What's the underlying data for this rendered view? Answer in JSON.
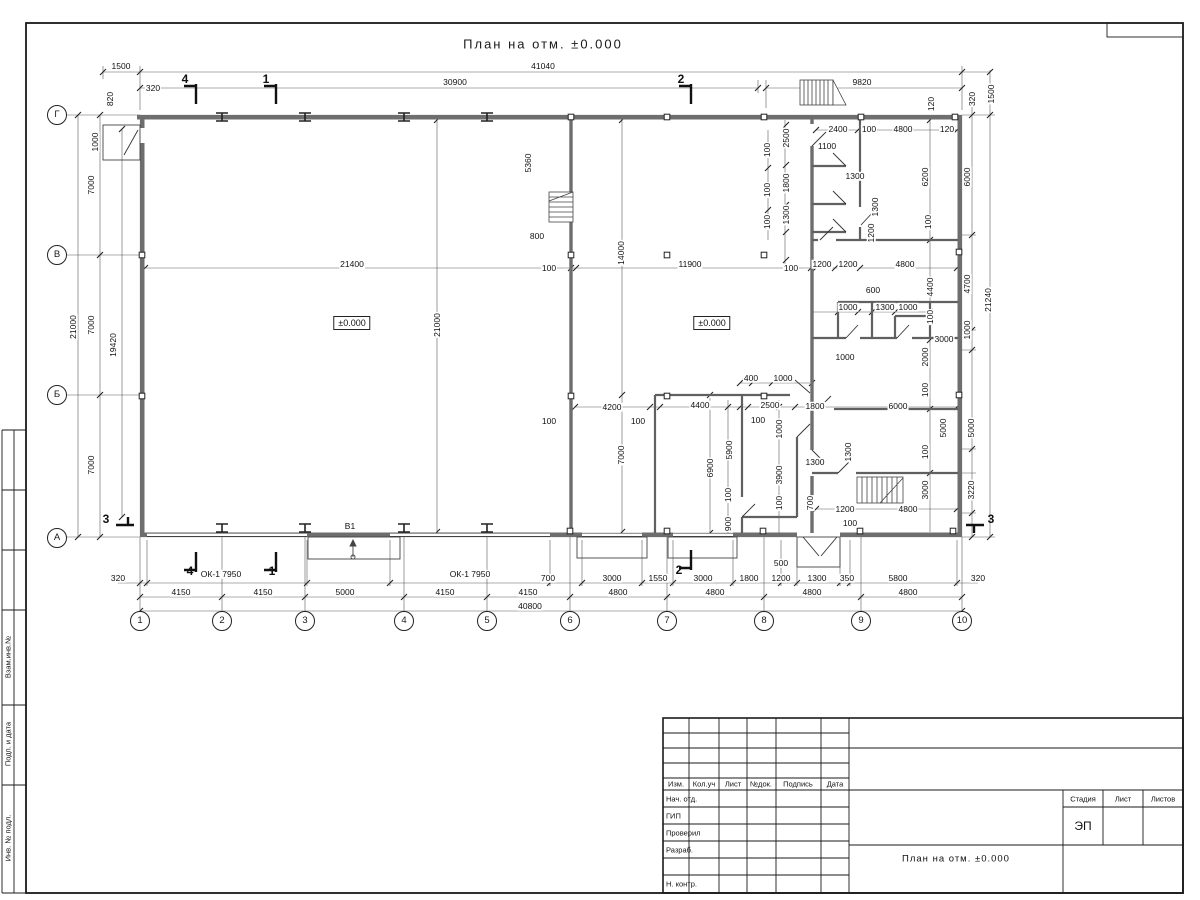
{
  "title": "План на отм. ±0.000",
  "plan": {
    "axes": {
      "cols": [
        {
          "n": "1",
          "x": 140
        },
        {
          "n": "2",
          "x": 222
        },
        {
          "n": "3",
          "x": 305
        },
        {
          "n": "4",
          "x": 404
        },
        {
          "n": "5",
          "x": 487
        },
        {
          "n": "6",
          "x": 570
        },
        {
          "n": "7",
          "x": 667
        },
        {
          "n": "8",
          "x": 764
        },
        {
          "n": "9",
          "x": 861
        },
        {
          "n": "10",
          "x": 962
        }
      ],
      "rows": [
        {
          "n": "Г",
          "y": 115
        },
        {
          "n": "В",
          "y": 255
        },
        {
          "n": "Б",
          "y": 395
        },
        {
          "n": "А",
          "y": 538
        }
      ]
    },
    "labels": [
      {
        "t": "1500",
        "x": 121,
        "y": 66
      },
      {
        "t": "41040",
        "x": 543,
        "y": 66
      },
      {
        "t": "30900",
        "x": 455,
        "y": 82
      },
      {
        "t": "9820",
        "x": 862,
        "y": 82
      },
      {
        "t": "320",
        "x": 153,
        "y": 88
      },
      {
        "t": "820",
        "x": 110,
        "y": 99,
        "r": 1
      },
      {
        "t": "120",
        "x": 931,
        "y": 104,
        "r": 1
      },
      {
        "t": "320",
        "x": 972,
        "y": 99,
        "r": 1
      },
      {
        "t": "1500",
        "x": 991,
        "y": 94,
        "r": 1
      },
      {
        "t": "4",
        "x": 185,
        "y": 79,
        "s": "sec"
      },
      {
        "t": "1",
        "x": 266,
        "y": 79,
        "s": "sec"
      },
      {
        "t": "2",
        "x": 681,
        "y": 79,
        "s": "sec"
      },
      {
        "t": "1000",
        "x": 95,
        "y": 142,
        "r": 1
      },
      {
        "t": "7000",
        "x": 91,
        "y": 185,
        "r": 1
      },
      {
        "t": "21000",
        "x": 73,
        "y": 327,
        "r": 1
      },
      {
        "t": "7000",
        "x": 91,
        "y": 325,
        "r": 1
      },
      {
        "t": "19420",
        "x": 113,
        "y": 345,
        "r": 1
      },
      {
        "t": "7000",
        "x": 91,
        "y": 465,
        "r": 1
      },
      {
        "t": "3",
        "x": 106,
        "y": 519,
        "s": "sec"
      },
      {
        "t": "5360",
        "x": 528,
        "y": 163,
        "r": 1
      },
      {
        "t": "800",
        "x": 537,
        "y": 236
      },
      {
        "t": "14000",
        "x": 621,
        "y": 253,
        "r": 1
      },
      {
        "t": "100",
        "x": 549,
        "y": 268
      },
      {
        "t": "21400",
        "x": 352,
        "y": 264
      },
      {
        "t": "11900",
        "x": 690,
        "y": 264
      },
      {
        "t": "100",
        "x": 791,
        "y": 268
      },
      {
        "t": "1200",
        "x": 822,
        "y": 264
      },
      {
        "t": "1200",
        "x": 848,
        "y": 264
      },
      {
        "t": "4800",
        "x": 905,
        "y": 264
      },
      {
        "t": "±0.000",
        "x": 352,
        "y": 323,
        "s": "box"
      },
      {
        "t": "±0.000",
        "x": 712,
        "y": 323,
        "s": "box"
      },
      {
        "t": "21000",
        "x": 437,
        "y": 325,
        "r": 1
      },
      {
        "t": "7000",
        "x": 621,
        "y": 455,
        "r": 1
      },
      {
        "t": "2400",
        "x": 838,
        "y": 129
      },
      {
        "t": "100",
        "x": 869,
        "y": 129
      },
      {
        "t": "4800",
        "x": 903,
        "y": 129
      },
      {
        "t": "120",
        "x": 947,
        "y": 129
      },
      {
        "t": "1100",
        "x": 827,
        "y": 146
      },
      {
        "t": "1300",
        "x": 855,
        "y": 176
      },
      {
        "t": "1300",
        "x": 875,
        "y": 207,
        "r": 1
      },
      {
        "t": "1200",
        "x": 871,
        "y": 233,
        "r": 1
      },
      {
        "t": "6200",
        "x": 925,
        "y": 177,
        "r": 1
      },
      {
        "t": "6000",
        "x": 967,
        "y": 177,
        "r": 1
      },
      {
        "t": "100",
        "x": 928,
        "y": 222,
        "r": 1
      },
      {
        "t": "2500",
        "x": 786,
        "y": 138,
        "r": 1
      },
      {
        "t": "100",
        "x": 767,
        "y": 150,
        "r": 1
      },
      {
        "t": "1800",
        "x": 786,
        "y": 183,
        "r": 1
      },
      {
        "t": "100",
        "x": 767,
        "y": 190,
        "r": 1
      },
      {
        "t": "1300",
        "x": 786,
        "y": 215,
        "r": 1
      },
      {
        "t": "100",
        "x": 767,
        "y": 222,
        "r": 1
      },
      {
        "t": "4400",
        "x": 930,
        "y": 287,
        "r": 1
      },
      {
        "t": "100",
        "x": 930,
        "y": 317,
        "r": 1
      },
      {
        "t": "4700",
        "x": 967,
        "y": 284,
        "r": 1
      },
      {
        "t": "21240",
        "x": 988,
        "y": 300,
        "r": 1
      },
      {
        "t": "1000",
        "x": 967,
        "y": 330,
        "r": 1
      },
      {
        "t": "600",
        "x": 873,
        "y": 290
      },
      {
        "t": "1000",
        "x": 848,
        "y": 307
      },
      {
        "t": "1300",
        "x": 885,
        "y": 307
      },
      {
        "t": "1000",
        "x": 908,
        "y": 307
      },
      {
        "t": "3000",
        "x": 944,
        "y": 339
      },
      {
        "t": "1000",
        "x": 845,
        "y": 357
      },
      {
        "t": "2000",
        "x": 925,
        "y": 357,
        "r": 1
      },
      {
        "t": "100",
        "x": 925,
        "y": 390,
        "r": 1
      },
      {
        "t": "1800",
        "x": 815,
        "y": 406
      },
      {
        "t": "6000",
        "x": 898,
        "y": 406
      },
      {
        "t": "5000",
        "x": 943,
        "y": 428,
        "r": 1
      },
      {
        "t": "5000",
        "x": 971,
        "y": 428,
        "r": 1
      },
      {
        "t": "100",
        "x": 925,
        "y": 452,
        "r": 1
      },
      {
        "t": "1300",
        "x": 815,
        "y": 462
      },
      {
        "t": "1300",
        "x": 848,
        "y": 452,
        "r": 1
      },
      {
        "t": "700",
        "x": 810,
        "y": 503,
        "r": 1
      },
      {
        "t": "3000",
        "x": 925,
        "y": 490,
        "r": 1
      },
      {
        "t": "3220",
        "x": 971,
        "y": 490,
        "r": 1
      },
      {
        "t": "1200",
        "x": 845,
        "y": 509
      },
      {
        "t": "100",
        "x": 850,
        "y": 523
      },
      {
        "t": "4800",
        "x": 908,
        "y": 509
      },
      {
        "t": "3",
        "x": 991,
        "y": 519,
        "s": "sec"
      },
      {
        "t": "100",
        "x": 549,
        "y": 421
      },
      {
        "t": "4200",
        "x": 612,
        "y": 407
      },
      {
        "t": "100",
        "x": 638,
        "y": 421
      },
      {
        "t": "4400",
        "x": 700,
        "y": 405
      },
      {
        "t": "100",
        "x": 758,
        "y": 420
      },
      {
        "t": "2500",
        "x": 770,
        "y": 405
      },
      {
        "t": "400",
        "x": 751,
        "y": 378
      },
      {
        "t": "1000",
        "x": 783,
        "y": 378
      },
      {
        "t": "1000",
        "x": 779,
        "y": 429,
        "r": 1
      },
      {
        "t": "6900",
        "x": 710,
        "y": 468,
        "r": 1
      },
      {
        "t": "5900",
        "x": 729,
        "y": 450,
        "r": 1
      },
      {
        "t": "100",
        "x": 728,
        "y": 495,
        "r": 1
      },
      {
        "t": "900",
        "x": 728,
        "y": 524,
        "r": 1
      },
      {
        "t": "3900",
        "x": 779,
        "y": 475,
        "r": 1
      },
      {
        "t": "100",
        "x": 779,
        "y": 503,
        "r": 1
      },
      {
        "t": "500",
        "x": 781,
        "y": 563
      },
      {
        "t": "В1",
        "x": 350,
        "y": 526
      },
      {
        "t": "320",
        "x": 118,
        "y": 578
      },
      {
        "t": "ОК-1 7950",
        "x": 221,
        "y": 574
      },
      {
        "t": "ОК-1 7950",
        "x": 470,
        "y": 574
      },
      {
        "t": "700",
        "x": 548,
        "y": 578
      },
      {
        "t": "3000",
        "x": 612,
        "y": 578
      },
      {
        "t": "1550",
        "x": 658,
        "y": 578
      },
      {
        "t": "3000",
        "x": 703,
        "y": 578
      },
      {
        "t": "1800",
        "x": 749,
        "y": 578
      },
      {
        "t": "1200",
        "x": 781,
        "y": 578
      },
      {
        "t": "1300",
        "x": 817,
        "y": 578
      },
      {
        "t": "350",
        "x": 847,
        "y": 578
      },
      {
        "t": "5800",
        "x": 898,
        "y": 578
      },
      {
        "t": "320",
        "x": 978,
        "y": 578
      },
      {
        "t": "4",
        "x": 190,
        "y": 571,
        "s": "sec"
      },
      {
        "t": "1",
        "x": 272,
        "y": 571,
        "s": "sec"
      },
      {
        "t": "2",
        "x": 679,
        "y": 570,
        "s": "sec"
      },
      {
        "t": "4150",
        "x": 181,
        "y": 592
      },
      {
        "t": "4150",
        "x": 263,
        "y": 592
      },
      {
        "t": "5000",
        "x": 345,
        "y": 592
      },
      {
        "t": "4150",
        "x": 445,
        "y": 592
      },
      {
        "t": "4150",
        "x": 528,
        "y": 592
      },
      {
        "t": "4800",
        "x": 618,
        "y": 592
      },
      {
        "t": "4800",
        "x": 715,
        "y": 592
      },
      {
        "t": "4800",
        "x": 812,
        "y": 592
      },
      {
        "t": "4800",
        "x": 908,
        "y": 592
      },
      {
        "t": "40800",
        "x": 530,
        "y": 606
      }
    ]
  },
  "frame": {
    "left_labels": [
      "Взам.инв.№",
      "Подп. и дата",
      "Инв. № подл."
    ]
  },
  "titleblock": {
    "rev_headers": [
      "Изм.",
      "Кол.уч",
      "Лист",
      "№док.",
      "Подпись",
      "Дата"
    ],
    "roles": [
      "Нач. отд.",
      "ГИП",
      "Проверил",
      "Разраб.",
      "",
      "Н. контр."
    ],
    "stage_headers": [
      "Стадия",
      "Лист",
      "Листов"
    ],
    "stage": "ЭП",
    "doc_title": "План на отм. ±0.000"
  }
}
